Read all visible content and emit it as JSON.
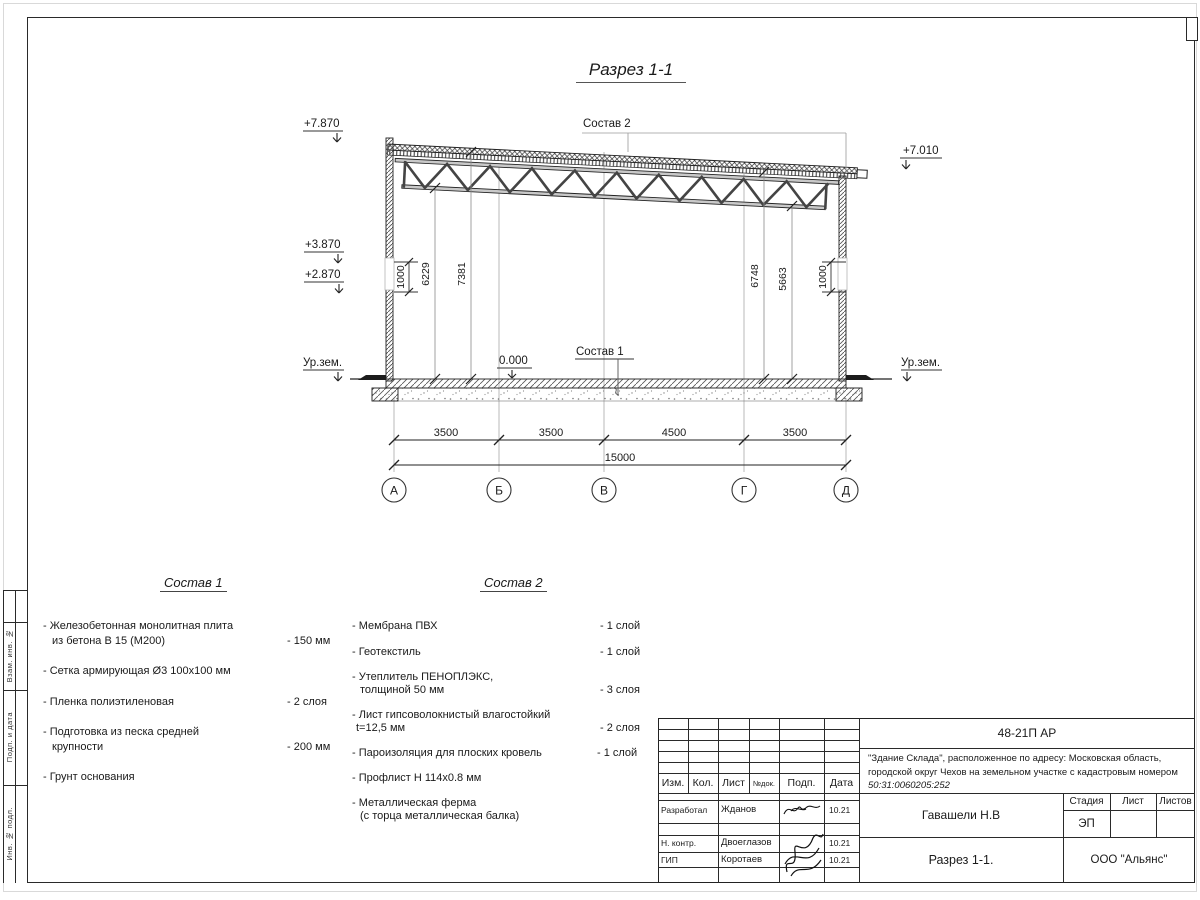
{
  "drawing": {
    "title": "Разрез 1-1",
    "callout_roof": "Состав 2",
    "callout_floor": "Состав 1",
    "elev_top_left": "+7.870",
    "elev_top_right": "+7.010",
    "elev_mid_upper": "+3.870",
    "elev_mid_lower": "+2.870",
    "elev_zero": "0.000",
    "ground_left": "Ур.зем.",
    "ground_right": "Ур.зем.",
    "dims_bottom": [
      "3500",
      "3500",
      "4500",
      "3500"
    ],
    "dim_total": "15000",
    "dims_left": [
      "1000",
      "6229",
      "7381"
    ],
    "dims_right": [
      "6748",
      "5663",
      "1000"
    ],
    "axes": [
      "А",
      "Б",
      "В",
      "Г",
      "Д"
    ]
  },
  "sostav1": {
    "title": "Состав 1",
    "rows": [
      {
        "t": "- Железобетонная  монолитная плита",
        "v": ""
      },
      {
        "t": "из бетона В 15 (М200)",
        "v": "- 150 мм"
      },
      {
        "t": "- Сетка армирующая Ø3 100х100 мм",
        "v": ""
      },
      {
        "t": "- Пленка полиэтиленовая",
        "v": "-  2 слоя"
      },
      {
        "t": "- Подготовка из песка средней",
        "v": ""
      },
      {
        "t": "крупности",
        "v": "- 200 мм"
      },
      {
        "t": "- Грунт основания",
        "v": ""
      }
    ]
  },
  "sostav2": {
    "title": "Состав 2",
    "rows": [
      {
        "t": "- Мембрана ПВХ",
        "v": "- 1 слой"
      },
      {
        "t": "- Геотекстиль",
        "v": "- 1 слой"
      },
      {
        "t": "- Утеплитель ПЕНОПЛЭКС,",
        "v": ""
      },
      {
        "t": "толщиной 50 мм",
        "v": "- 3 слоя"
      },
      {
        "t": "- Лист гипсоволокнистый влагостойкий",
        "v": ""
      },
      {
        "t": "t=12,5 мм",
        "v": "- 2 слоя"
      },
      {
        "t": "- Пароизоляция для плоских кровель",
        "v": "- 1 слой"
      },
      {
        "t": "- Профлист Н 114х0.8 мм",
        "v": ""
      },
      {
        "t": "- Металлическая ферма",
        "v": ""
      },
      {
        "t": "(с торца металлическая балка)",
        "v": ""
      }
    ]
  },
  "titleblock": {
    "doc_number": "48-21П АР",
    "project_line1": "\"Здание Склада\", расположенное по адресу: Московская область,",
    "project_line2": "городской округ Чехов на земельном участке с кадастровым",
    "project_line3": "номером ",
    "cadastral": "50:31:0060205:252",
    "cols": [
      "Изм.",
      "Кол.",
      "Лист",
      "№док.",
      "Подп.",
      "Дата"
    ],
    "rows": [
      {
        "role": "Разработал",
        "name": "Жданов",
        "date": "10.21"
      },
      {
        "role": "Н. контр.",
        "name": "Двоеглазов",
        "date": "10.21"
      },
      {
        "role": "ГИП",
        "name": "Коротаев",
        "date": "10.21"
      }
    ],
    "author": "Гавашели Н.В",
    "stage_label": "Стадия",
    "sheet_label": "Лист",
    "sheets_label": "Листов",
    "stage_value": "ЭП",
    "drawing_title": "Разрез 1-1.",
    "company": "ООО \"Альянс\""
  },
  "frame_strip": {
    "v1": "Взам. инв. №",
    "v2": "Подп. и дата",
    "v3": "Инв. № подл."
  }
}
